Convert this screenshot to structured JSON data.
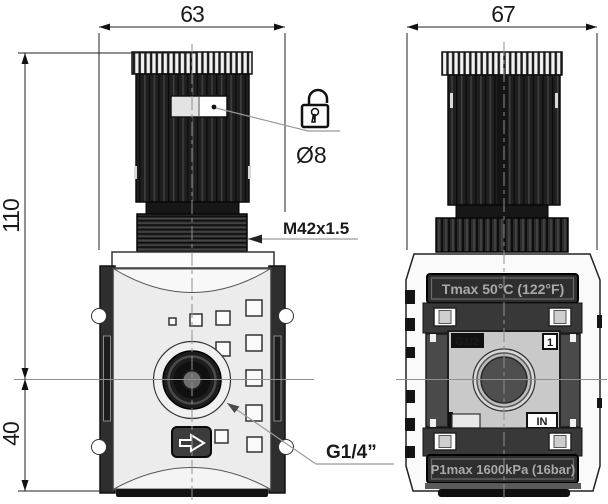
{
  "drawing_type": "technical-dimension-drawing",
  "subject": "pneumatic pressure regulator, front and side views",
  "dimensions": {
    "front_width": "63",
    "side_width": "67",
    "height_above_centerline": "110",
    "height_below_centerline": "40"
  },
  "annotations": {
    "bonnet_thread": "M42x1.5",
    "lock_hole_diameter": "Ø8",
    "outlet_port": "G1/4”"
  },
  "side_view_markings": {
    "tmax": "Tmax 50°C (122°F)",
    "p1max": "P1max 1600kPa (16bar)",
    "gauge_port": "G1/2",
    "port_number": "1",
    "inlet": "IN"
  },
  "icons": {
    "padlock": "open-padlock (lockable knob indicator)",
    "flow_arrow": "flow-direction arrow, pointing right"
  },
  "colors": {
    "line": "#222222",
    "leader": "#8a8a8a",
    "centerline": "#8f8f8f",
    "knob_dark": "#1f1f1f",
    "body_light": "#ececec",
    "plate_dark": "#2e2e2e",
    "plate_text": "#a9a9a9",
    "background": "#ffffff"
  }
}
